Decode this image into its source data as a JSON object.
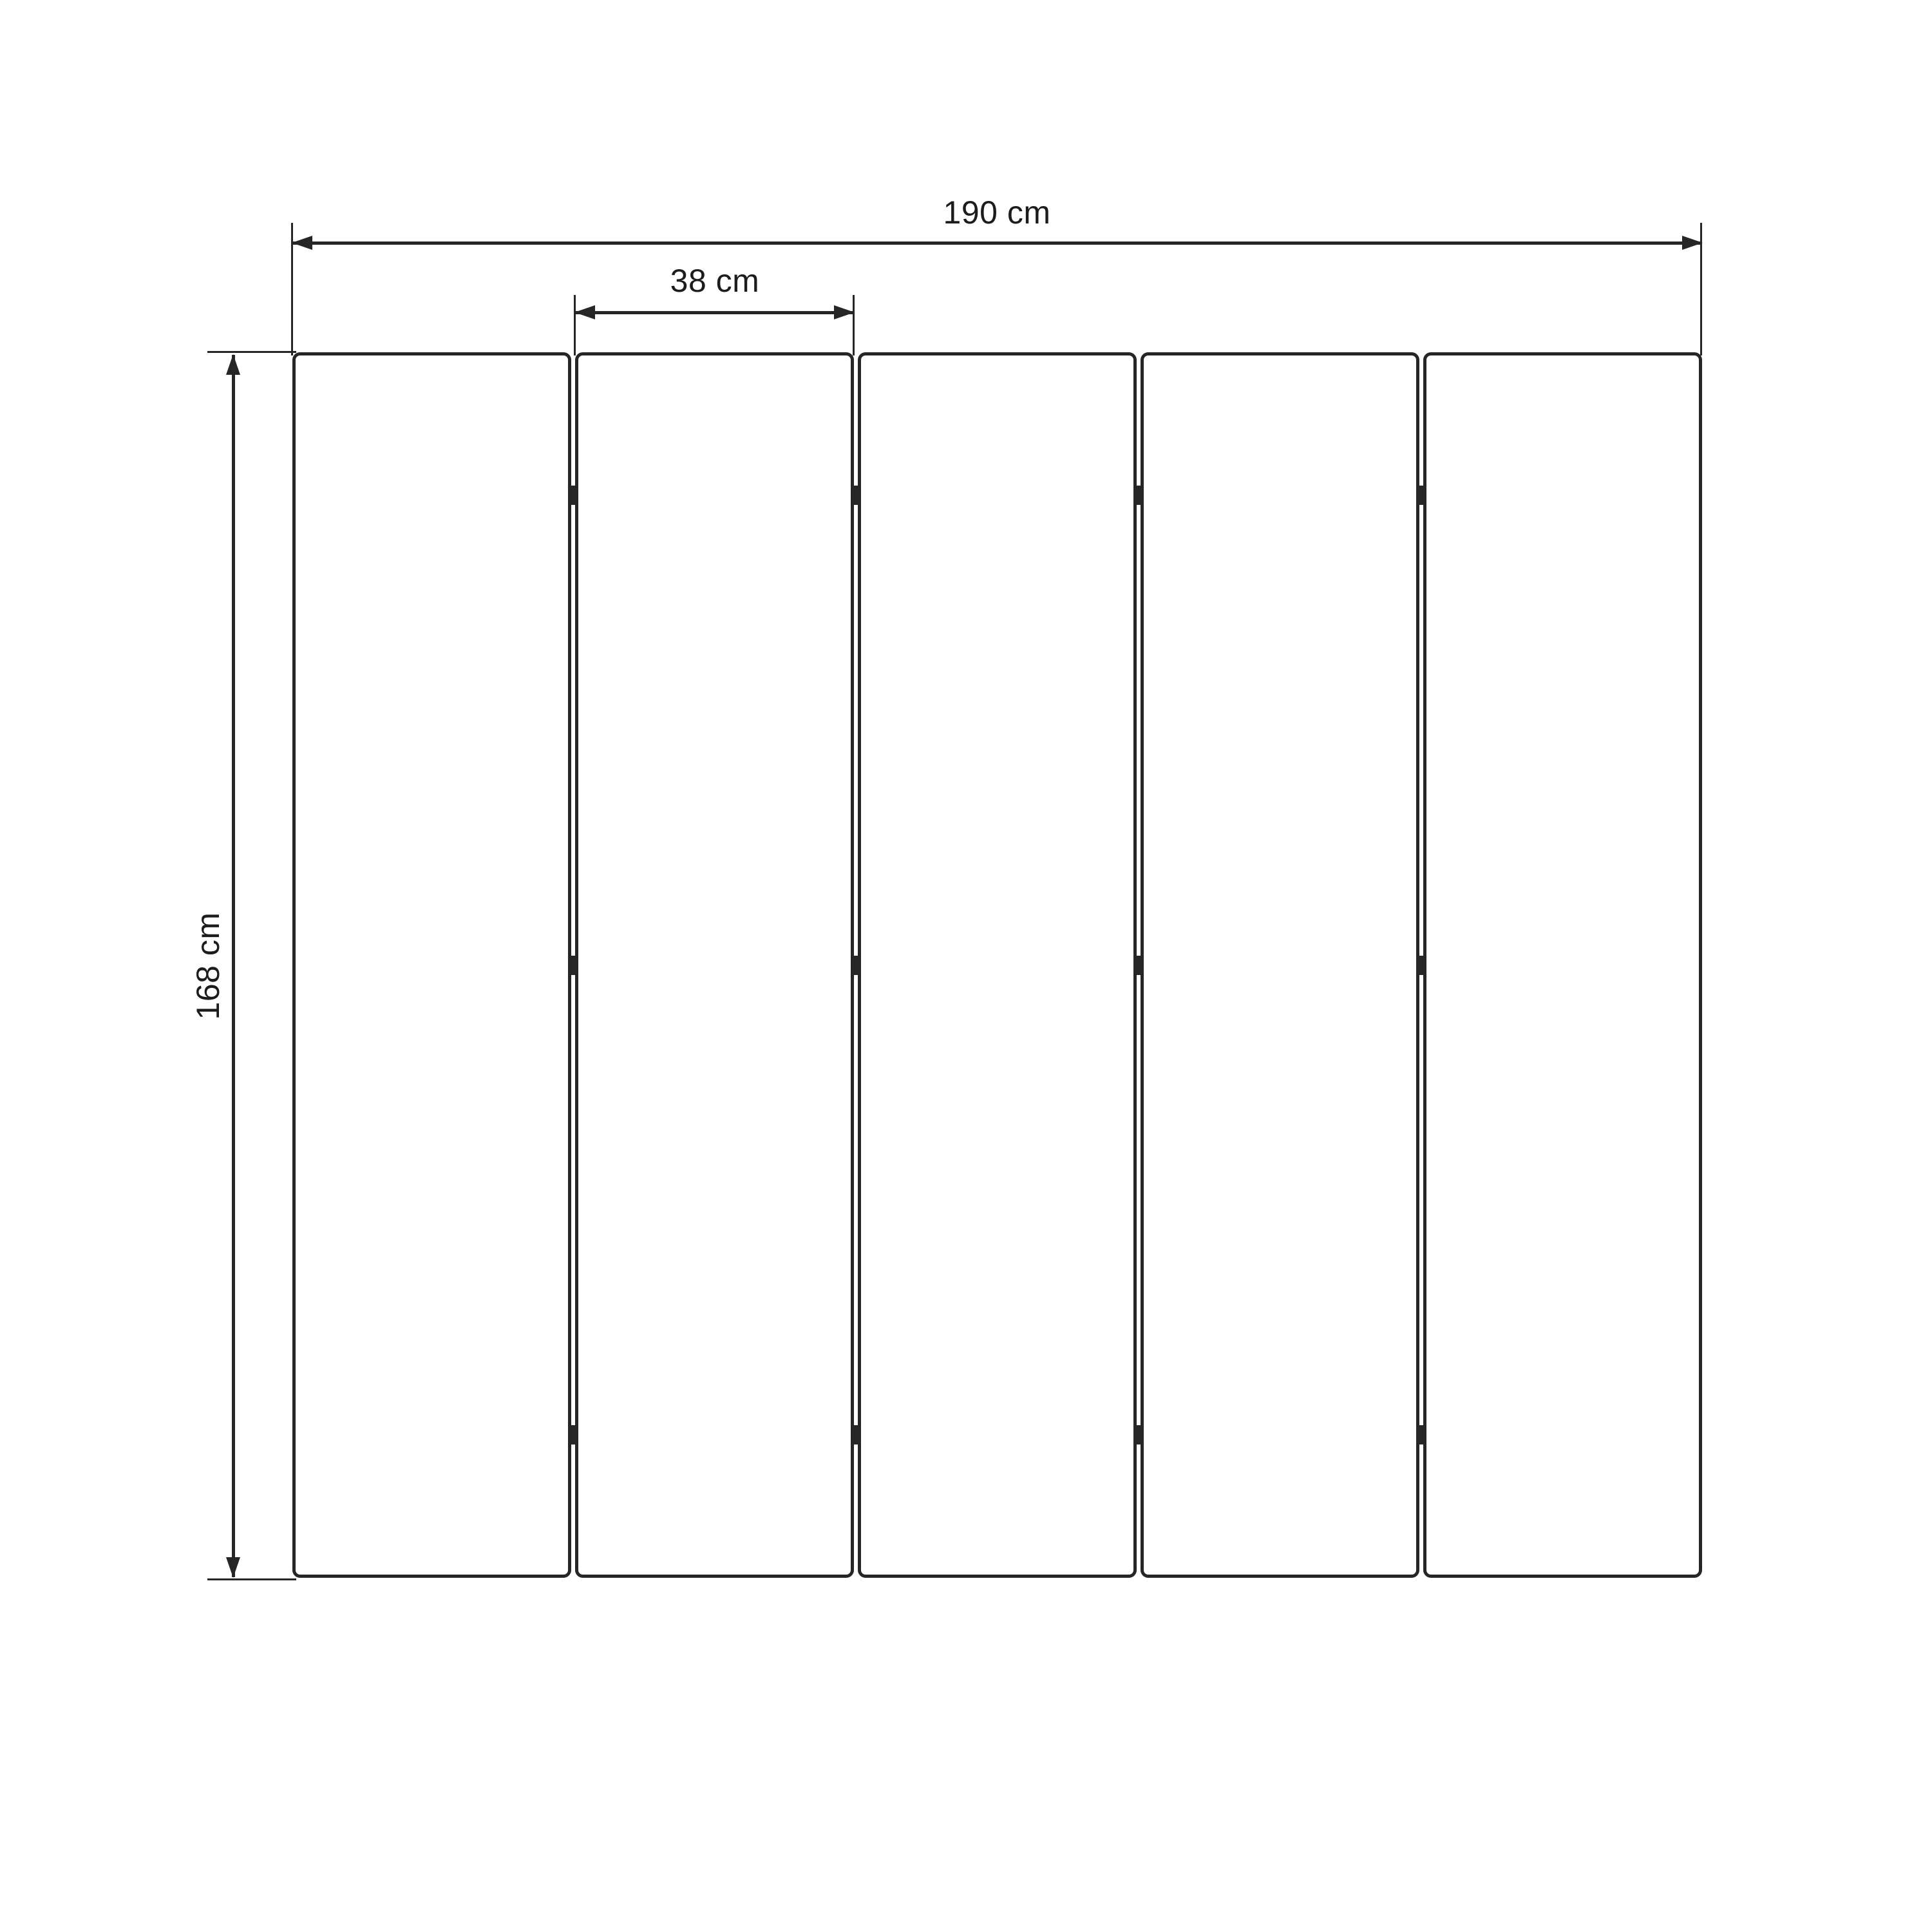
{
  "diagram": {
    "panel_count": 5,
    "joint_count": 4,
    "hinges_per_joint": 3,
    "labels": {
      "total_width": "190 cm",
      "panel_width": "38 cm",
      "height": "168 cm"
    },
    "colors": {
      "stroke": "#262626",
      "text": "#1c1c1c",
      "background": "#ffffff"
    }
  }
}
